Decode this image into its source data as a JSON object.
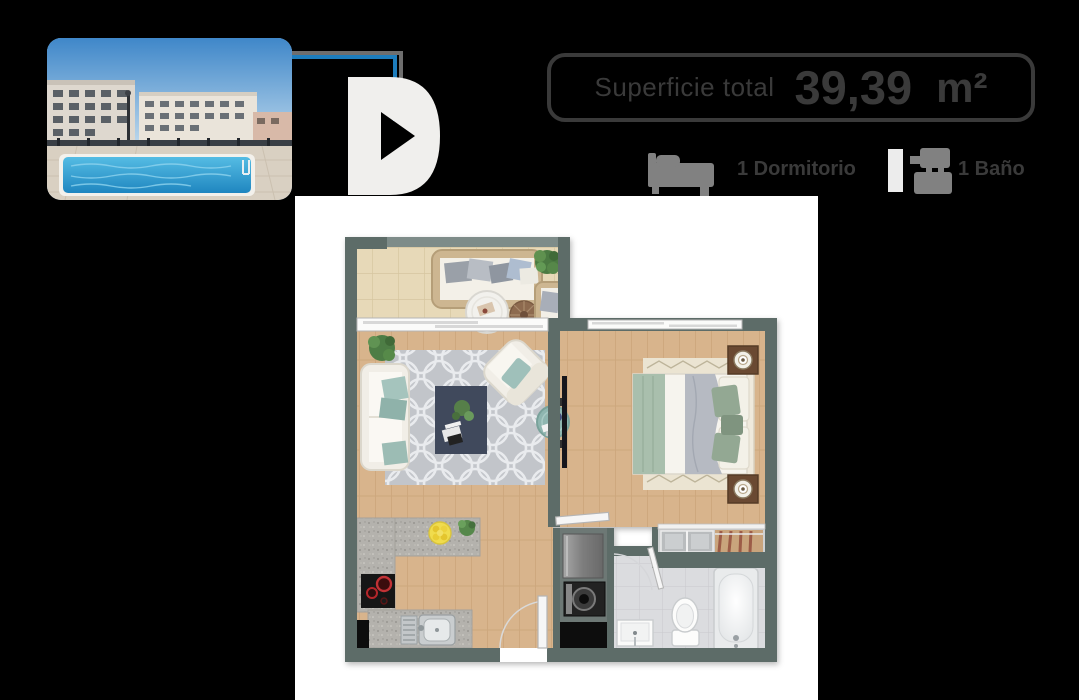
{
  "window": {
    "background": "#000000"
  },
  "photo": {
    "name": "building-pool-photo"
  },
  "unit_type": {
    "letter": "D"
  },
  "area_badge": {
    "label": "Superficie total",
    "value": "39,39",
    "unit": "m²"
  },
  "specs": {
    "bedrooms": {
      "icon": "bed-icon",
      "label": "1 Dormitorio"
    },
    "bathrooms": {
      "icon": "shower-icon",
      "label": "1 Baño"
    }
  },
  "colors": {
    "accent_line": "#1d7dbd",
    "accent_line_shadow": "#6e6e6e",
    "badge_border": "#3a3a3a",
    "text": "#3a3a3a",
    "icon_gray": "#818181",
    "icon_light": "#ececec",
    "letter": "#f0efed",
    "panel": "#ffffff",
    "plan_wall": "#5d6c68",
    "plan_wood": "#d8b48c",
    "plan_terrace": "#e7d9b8",
    "plan_bath_tile": "#dbdcdf",
    "accent_teal": "#9fc0ba",
    "pool_blue": "#2f9fd6"
  },
  "floor_plan": {
    "rooms": [
      "terraza",
      "living-comedor",
      "dormitorio",
      "cocina",
      "baño",
      "closet",
      "logia"
    ]
  }
}
